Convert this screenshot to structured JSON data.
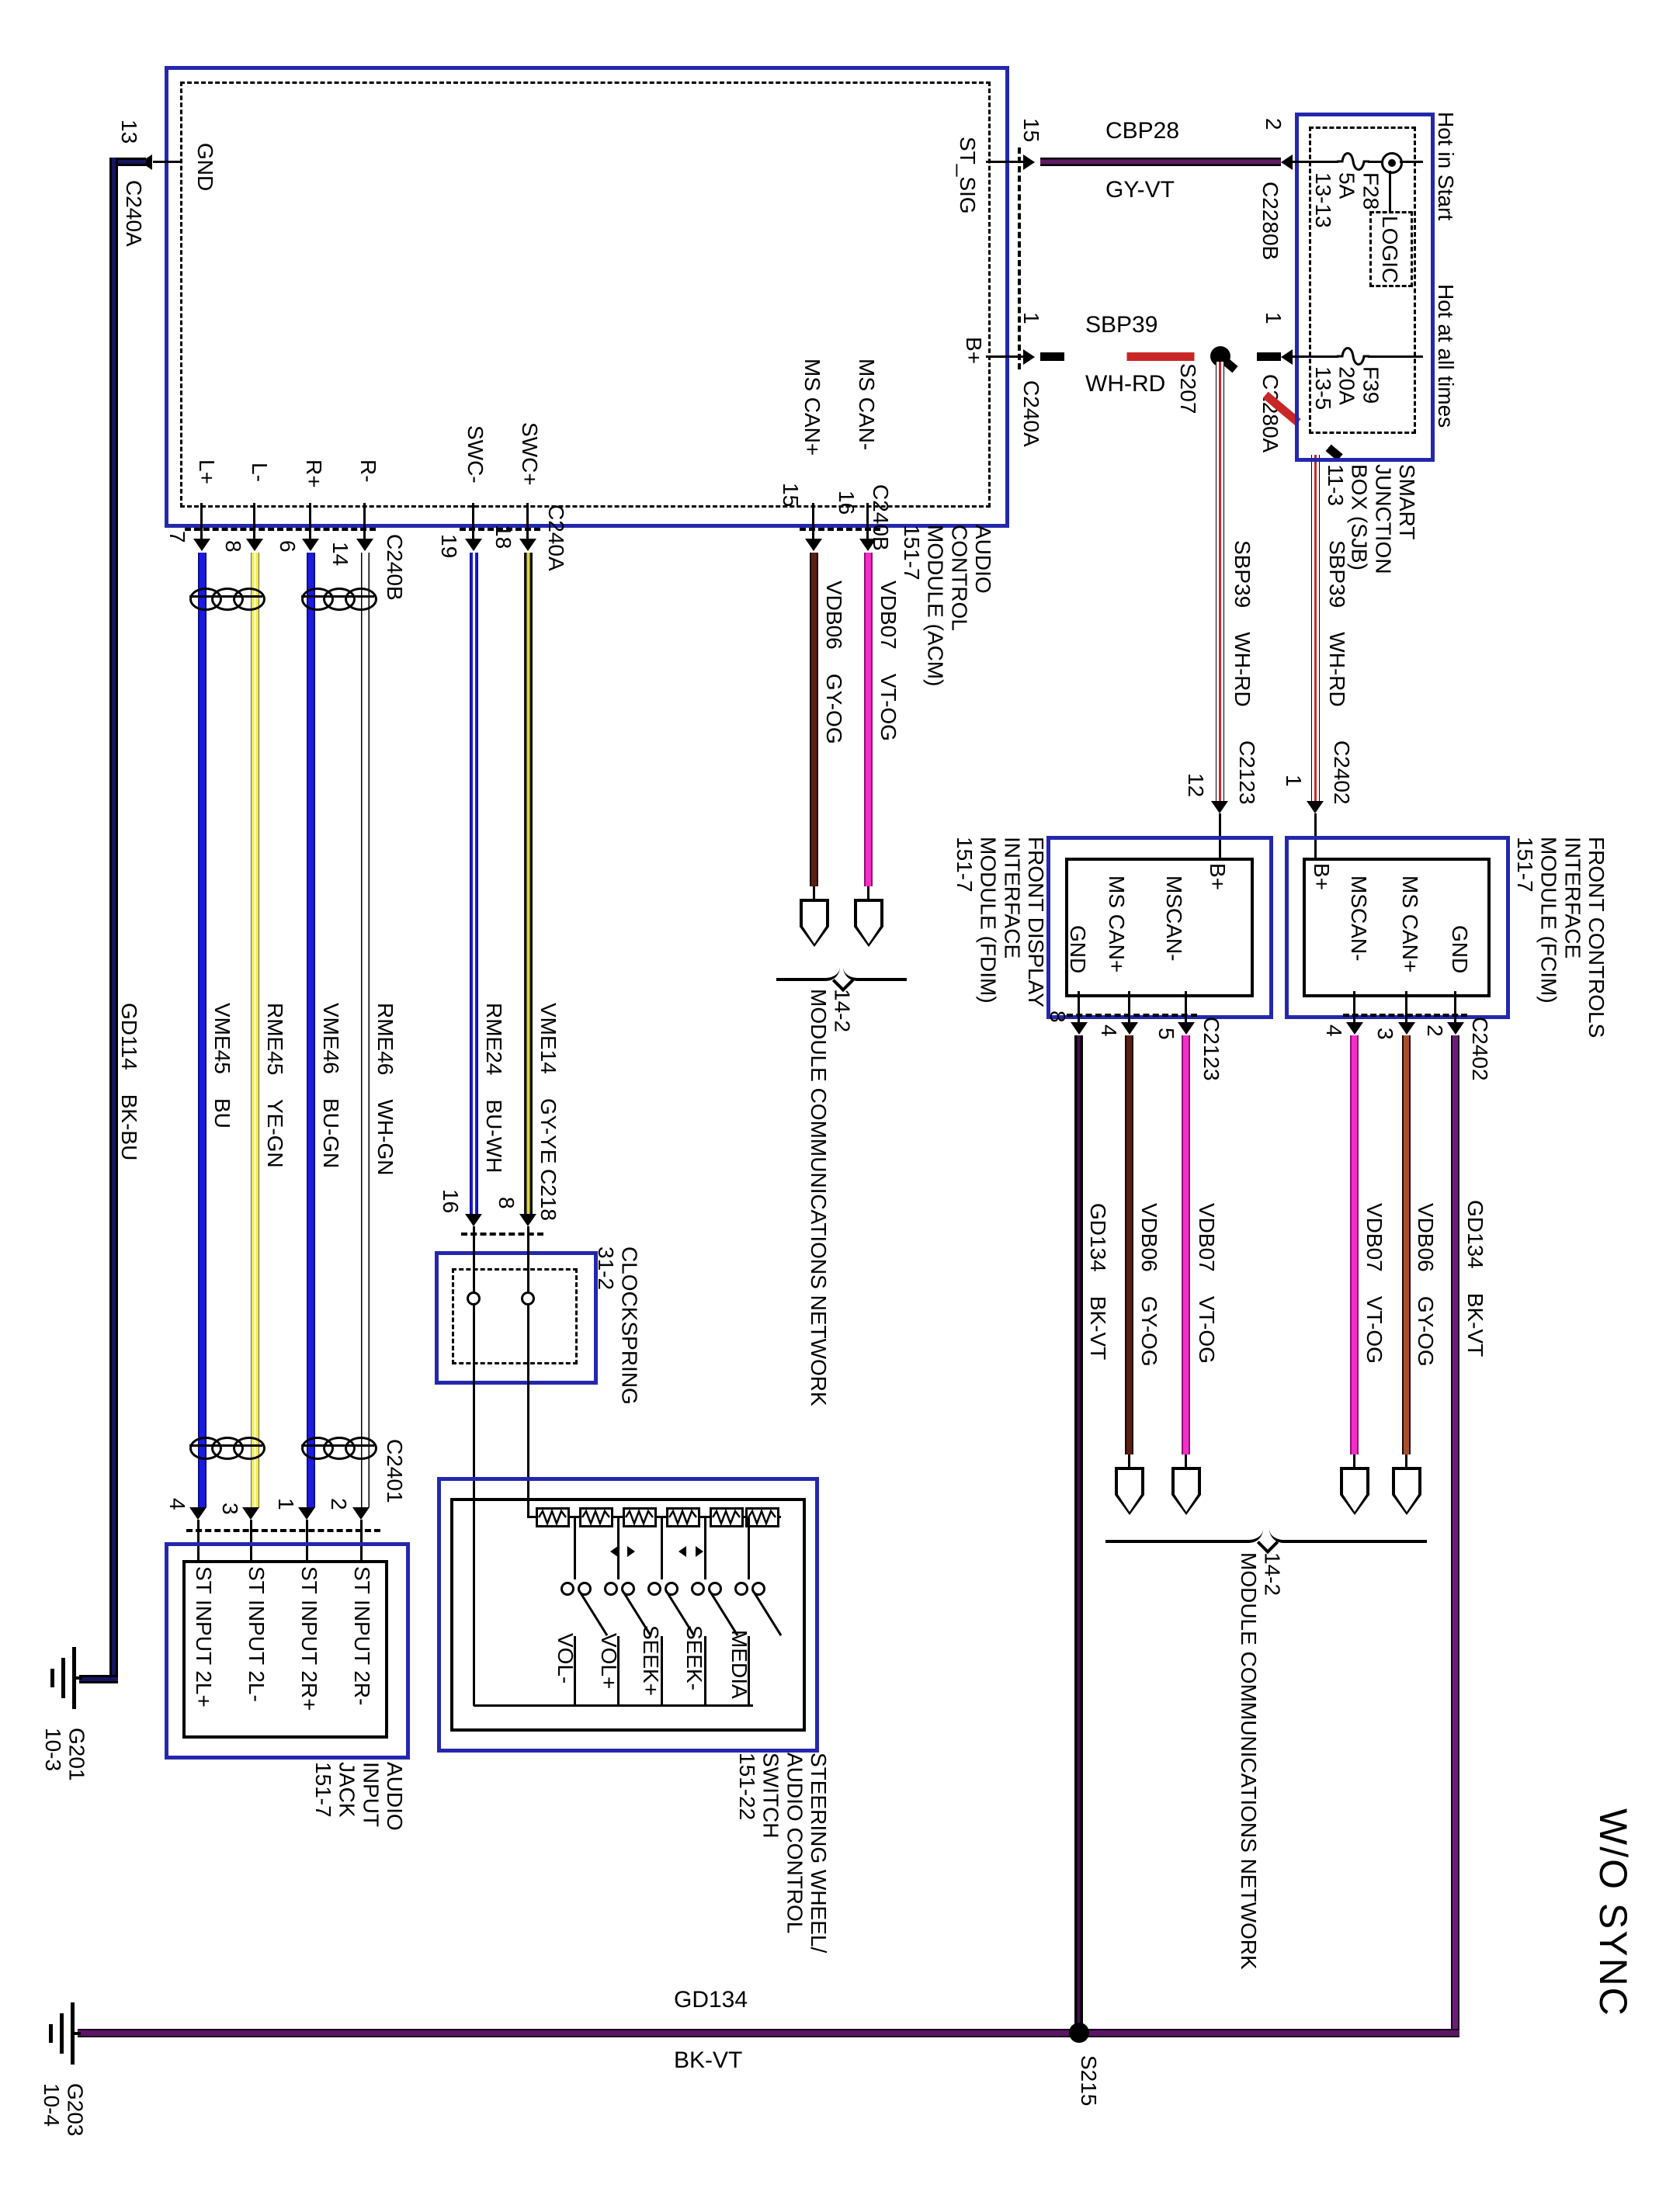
{
  "colors": {
    "box_blue": "#2427ae",
    "line_black": "#000000",
    "wire_blue": "#1b1be0",
    "wire_yellow": "#f1ed49",
    "wire_pink": "#f42fc6",
    "wire_maroon": "#5d1d12",
    "wire_rust": "#a8502c",
    "wire_purple": "#711a7e",
    "wire_red": "#c92727",
    "wire_dk_violet": "#5e1c63",
    "wire_navy": "#15155e"
  },
  "pins": {
    "n1": "1",
    "n2": "2",
    "n3": "3",
    "n4": "4",
    "n5": "5",
    "n6": "6",
    "n7": "7",
    "n8": "8",
    "n12": "12",
    "n13": "13",
    "n14": "14",
    "n15": "15",
    "n16": "16",
    "n18": "18",
    "n19": "19"
  },
  "conn": {
    "c240a": "C240A",
    "c240b": "C240B",
    "c2280a": "C2280A",
    "c2280b": "C2280B",
    "c2123": "C2123",
    "c2402": "C2402",
    "c2401": "C2401",
    "c218": "C218"
  },
  "acm": {
    "title": "AUDIO\nCONTROL\nMODULE (ACM)\n151-7",
    "gnd": "GND",
    "st_sig": "ST_SIG",
    "b_plus": "B+",
    "ms_can_plus": "MS CAN+",
    "ms_can_minus": "MS CAN-",
    "l_plus": "L+",
    "l_minus": "L-",
    "r_plus": "R+",
    "r_minus": "R-",
    "swc_minus": "SWC-",
    "swc_plus": "SWC+"
  },
  "sjb": {
    "title": "SMART\nJUNCTION\nBOX (SJB)\n11-3",
    "hot_in_start": "Hot in Start",
    "hot_at_all_times": "Hot at all times",
    "fuse_f28": "F28\n5A\n13-13",
    "fuse_f39": "F39\n20A\n13-5",
    "logic": "LOGIC"
  },
  "fdim": {
    "title": "FRONT DISPLAY\nINTERFACE\nMODULE (FDIM)\n151-7",
    "b_plus": "B+",
    "mscan_minus": "MSCAN-",
    "ms_can_plus": "MS CAN+",
    "gnd": "GND"
  },
  "fcim": {
    "title": "FRONT CONTROLS\nINTERFACE\nMODULE (FCIM)\n151-7",
    "b_plus": "B+",
    "mscan_minus": "MSCAN-",
    "ms_can_plus": "MS CAN+",
    "gnd": "GND"
  },
  "clockspring": {
    "title": "CLOCKSPRING\n31-2"
  },
  "swc_switch": {
    "title": "STEERING WHEEL/\nAUDIO CONTROL\nSWITCH\n151-22",
    "vol_minus": "VOL-",
    "vol_plus": "VOL+",
    "seek_plus": "SEEK+",
    "seek_minus": "SEEK-",
    "media": "MEDIA"
  },
  "jack": {
    "title": "AUDIO\nINPUT\nJACK\n151-7",
    "in_2l_plus": "ST INPUT 2L+",
    "in_2l_minus": "ST INPUT 2L-",
    "in_2r_plus": "ST INPUT 2R+",
    "in_2r_minus": "ST INPUT 2R-"
  },
  "wires": {
    "cbp28_name": "CBP28",
    "cbp28_color": "GY-VT",
    "sbp39_name": "SBP39",
    "sbp39_color": "WH-RD",
    "sbp39_whrd": "SBP39    WH-RD",
    "gd134_name": "GD134",
    "gd134_color": "BK-VT",
    "gd134_bkvt": "GD134    BK-VT",
    "gd114_bkbu": "GD114    BK-BU",
    "vme45_bu": "VME45    BU",
    "rme45_yegn": "RME45    YE-GN",
    "vme46_bugn": "VME46    BU-GN",
    "rme46_whgn": "RME46    WH-GN",
    "rme24_buwh": "RME24    BU-WH",
    "vme14_gyye": "VME14    GY-YE",
    "vdb06_gyog": "VDB06    GY-OG",
    "vdb07_vtog": "VDB07    VT-OG"
  },
  "splices": {
    "s207": "S207",
    "s215": "S215"
  },
  "grounds": {
    "g201": "G201\n10-3",
    "g203": "G203\n10-4"
  },
  "network": {
    "label": "14-2\nMODULE COMMUNICATIONS NETWORK"
  },
  "misc": {
    "wo_sync": "W/O SYNC"
  }
}
